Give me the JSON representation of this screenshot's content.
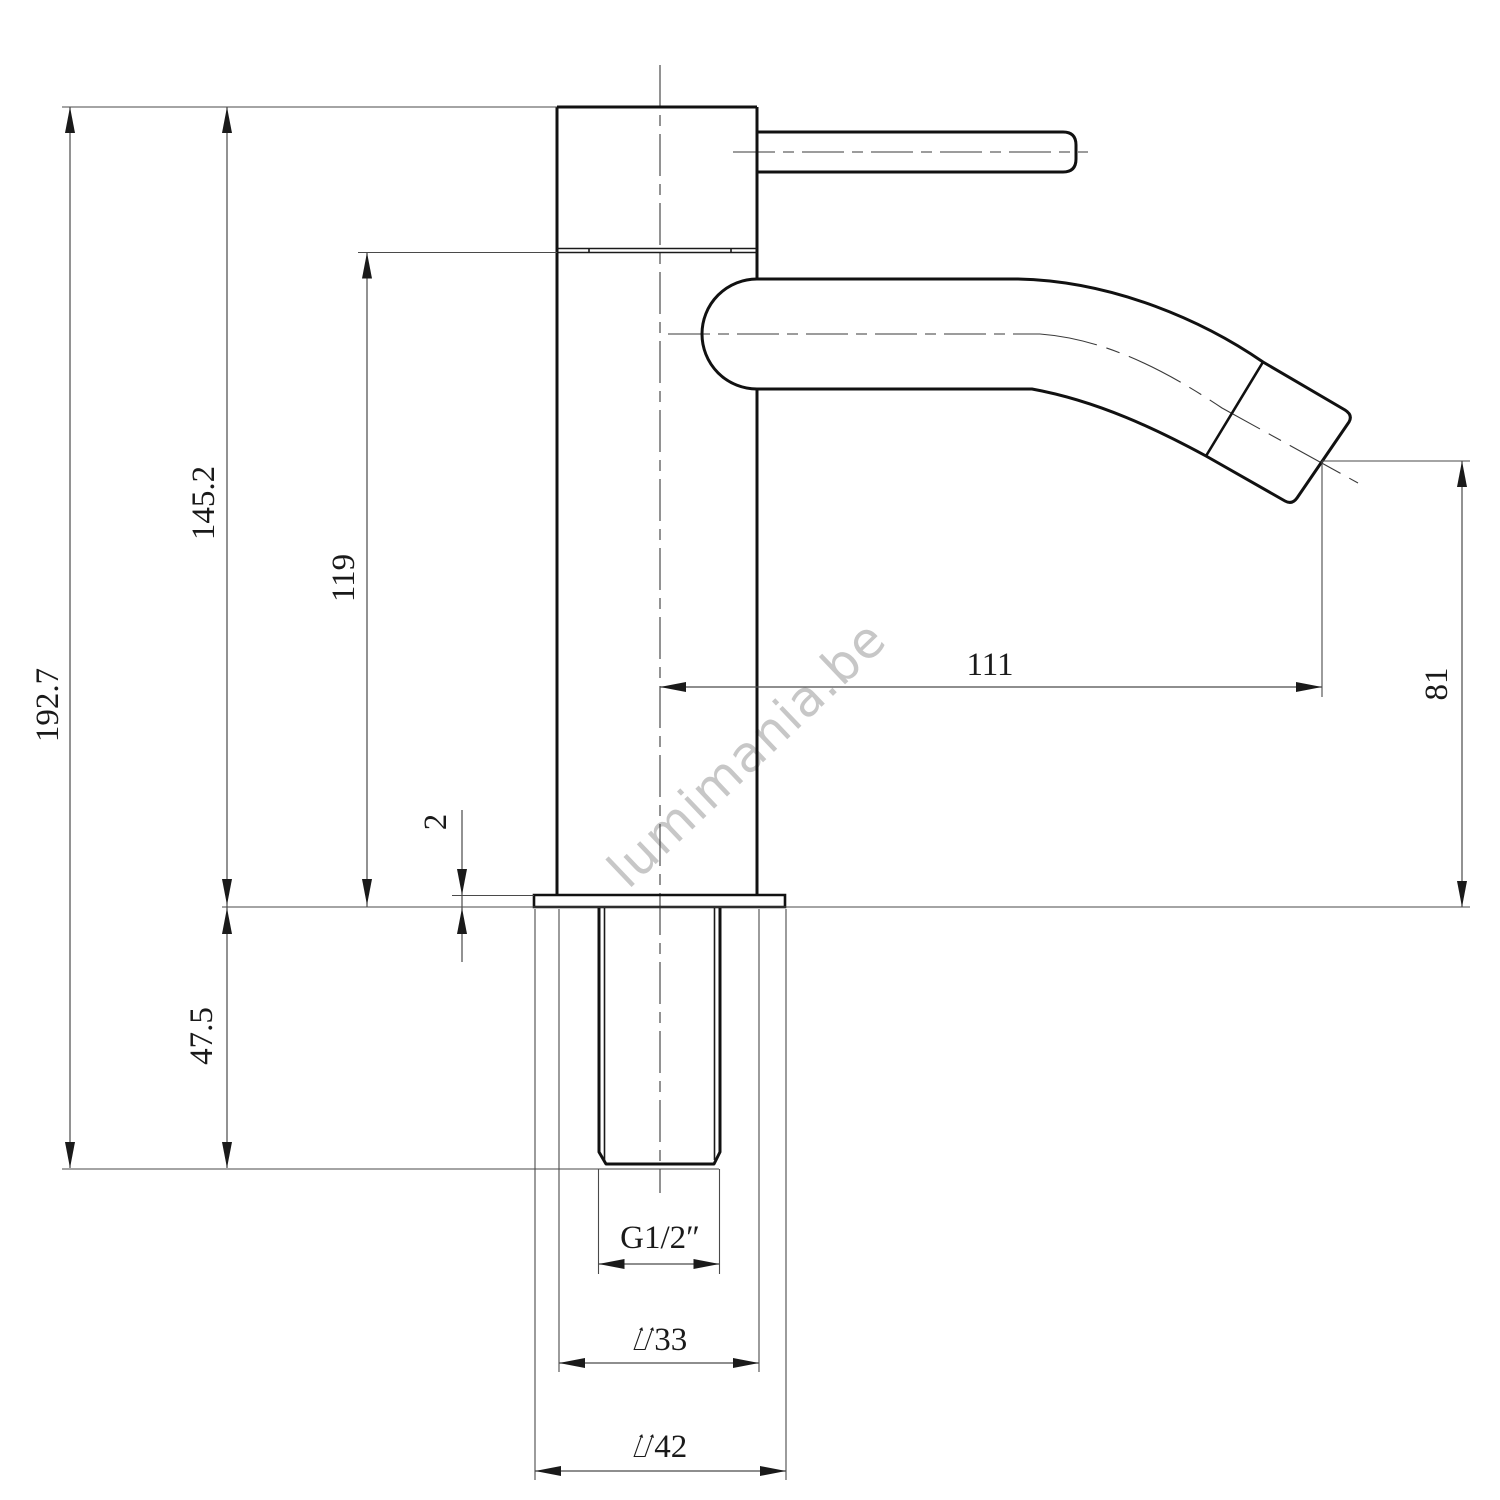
{
  "drawing": {
    "watermark": "lumimania.be",
    "dimensions": {
      "overall_height": "192.7",
      "deck_to_top": "145.2",
      "spout_centre_height": "119",
      "deck_plate_thickness": "2",
      "shank_length": "47.5",
      "spout_reach": "111",
      "spout_outlet_height": "81",
      "thread_size": "G1/2″",
      "body_diameter": "⌰33",
      "base_diameter": "⌰42"
    },
    "colors": {
      "outline": "#111111",
      "dimension_line": "#4a4a4a",
      "watermark": "#c7c7c7"
    }
  }
}
